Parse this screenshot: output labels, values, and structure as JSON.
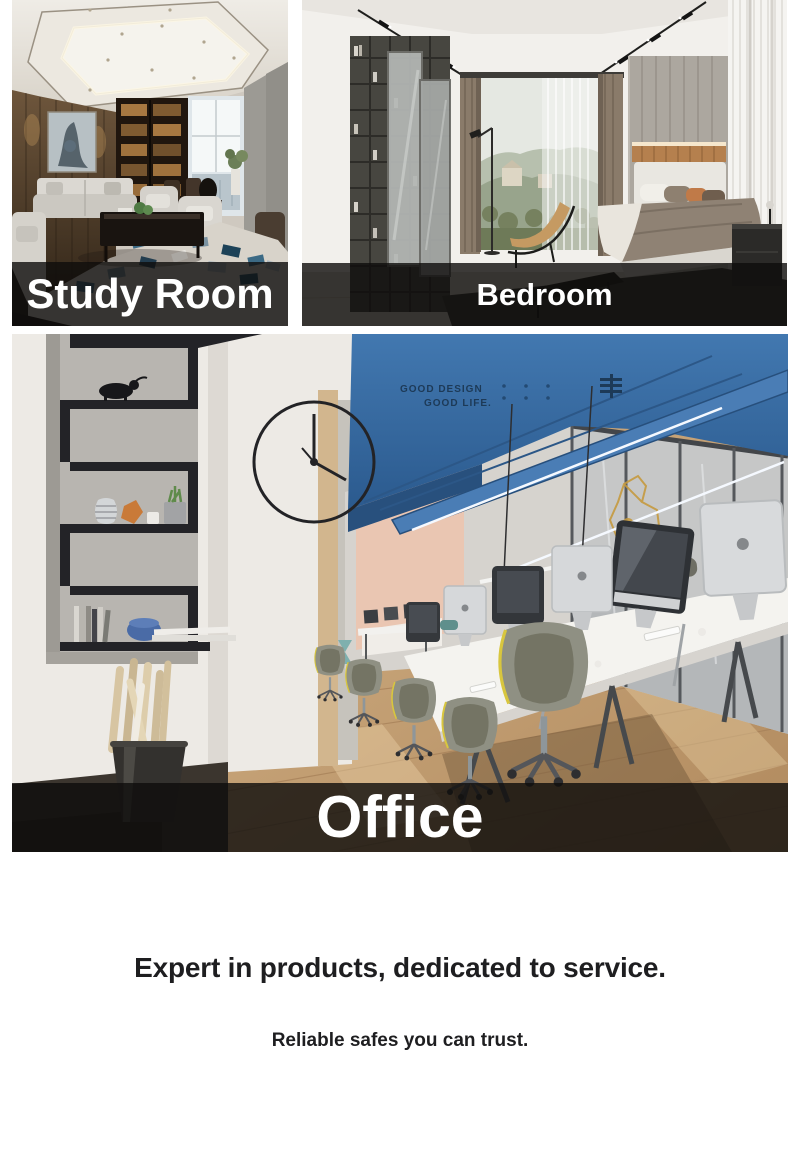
{
  "gallery": {
    "items": [
      {
        "id": "study-room",
        "label": "Study Room"
      },
      {
        "id": "bedroom",
        "label": "Bedroom"
      },
      {
        "id": "office",
        "label": "Office"
      }
    ],
    "office_ceiling_text": {
      "line1": "GOOD DESIGN",
      "line2": "GOOD LIFE."
    }
  },
  "tagline": {
    "heading": "Expert in products, dedicated to service.",
    "subheading": "Reliable safes you can trust."
  },
  "colors": {
    "page_background": "#ffffff",
    "caption_overlay": "rgba(14,12,11,0.8)",
    "caption_text": "#ffffff",
    "tagline_text": "#1e1e20",
    "office_ceiling_blue": "#3b6da4",
    "wood_floor": "#c9a87f"
  }
}
